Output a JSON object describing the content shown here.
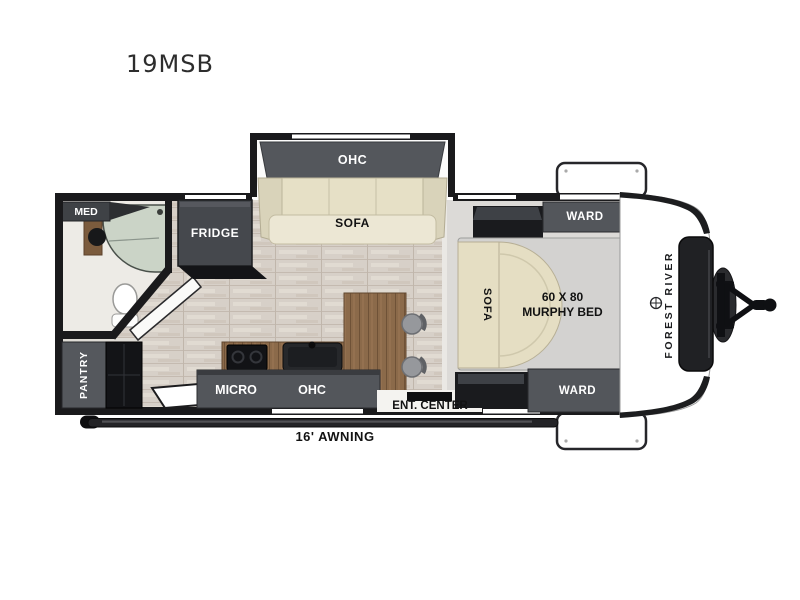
{
  "title": "19MSB",
  "floorplan": {
    "bathroom": {
      "med": "MED"
    },
    "kitchen": {
      "fridge": "FRIDGE",
      "pantry": "PANTRY",
      "micro": "MICRO",
      "ohc": "OHC"
    },
    "slideout": {
      "ohc": "OHC",
      "sofa": "SOFA"
    },
    "bedroom": {
      "ward_top": "WARD",
      "ward_bottom": "WARD",
      "sofa": "SOFA",
      "bed_size": "60 X 80",
      "bed_type": "MURPHY BED",
      "ent_center": "ENT. CENTER"
    },
    "exterior": {
      "awning": "16' AWNING",
      "brand": "FOREST RIVER"
    }
  },
  "colors": {
    "wall": "#1a1a1c",
    "cabinet_gray": "#53565b",
    "cabinet_black": "#141518",
    "sofa_cream": "#e6dfc6",
    "wood": "#8b6a4a",
    "carpet": "#dcdad7",
    "laminate": "#d7d0c8",
    "shower": "#cbd4c7",
    "bed_gray": "#d3d2d0",
    "background": "#ffffff"
  }
}
